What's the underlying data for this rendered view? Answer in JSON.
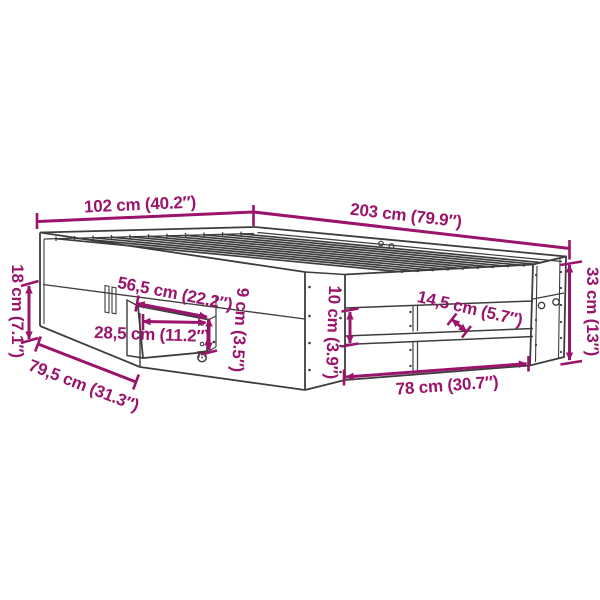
{
  "title": "Bed frame dimension diagram",
  "colors": {
    "dimension_accent": "#9A146B",
    "drawing_line": "#3d3d3d",
    "background": "#ffffff"
  },
  "dims": {
    "width_top": "102 cm (40.2″)",
    "length_top": "203 cm (79.9″)",
    "head_lower_height": "18 cm (7.1″)",
    "side_height": "33 cm (13″)",
    "drawer_extension": "56,5 cm (22.2″)",
    "drawer_width": "28,5 cm (11.2″)",
    "drawer_depth": "79,5 cm (31.3″)",
    "drawer_height": "9 cm (3.5″)",
    "rail_gap": "10 cm (3.9″)",
    "shelf_gap": "14,5 cm (5.7″)",
    "shelf_width": "78 cm (30.7″)"
  }
}
